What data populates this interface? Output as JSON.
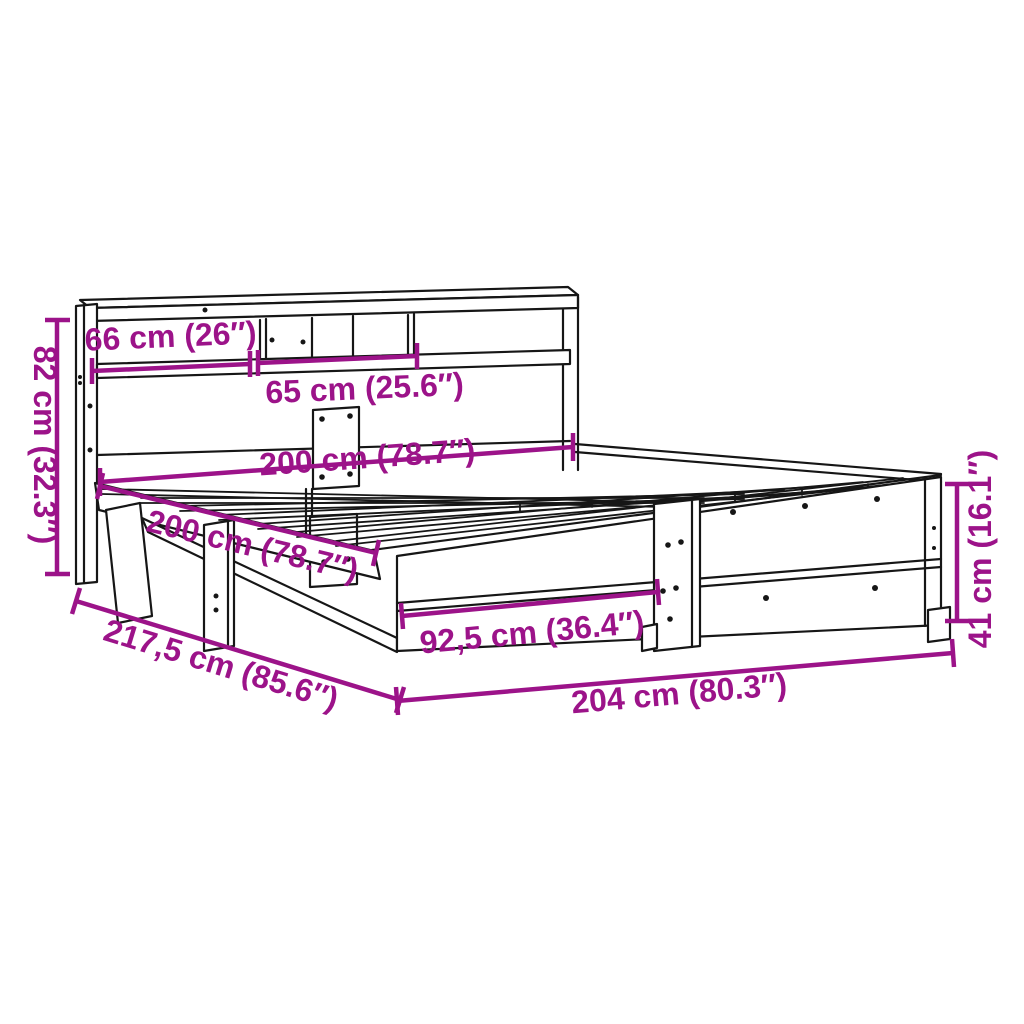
{
  "diagram": {
    "title": "Bed frame with bookcase headboard — dimension diagram",
    "product": "bookcase-bed-frame",
    "colors": {
      "dimension_accent": "#9C1389",
      "outline": "#161616",
      "background": "#FFFFFF"
    },
    "dimensions": [
      {
        "id": "headboard-shelf-left",
        "label": "66 cm (26″)"
      },
      {
        "id": "headboard-shelf-right",
        "label": "65 cm (25.6″)"
      },
      {
        "id": "headboard-height",
        "label": "82 cm (32.3″)"
      },
      {
        "id": "bed-inner-width",
        "label": "200 cm (78.7″)"
      },
      {
        "id": "bed-inner-length",
        "label": "200 cm (78.7″)"
      },
      {
        "id": "footboard-panel-width",
        "label": "92,5 cm (36.4″)"
      },
      {
        "id": "total-length",
        "label": "217,5 cm (85.6″)"
      },
      {
        "id": "total-width",
        "label": "204 cm (80.3″)"
      },
      {
        "id": "side-rail-height",
        "label": "41 cm (16.1″)"
      }
    ]
  }
}
